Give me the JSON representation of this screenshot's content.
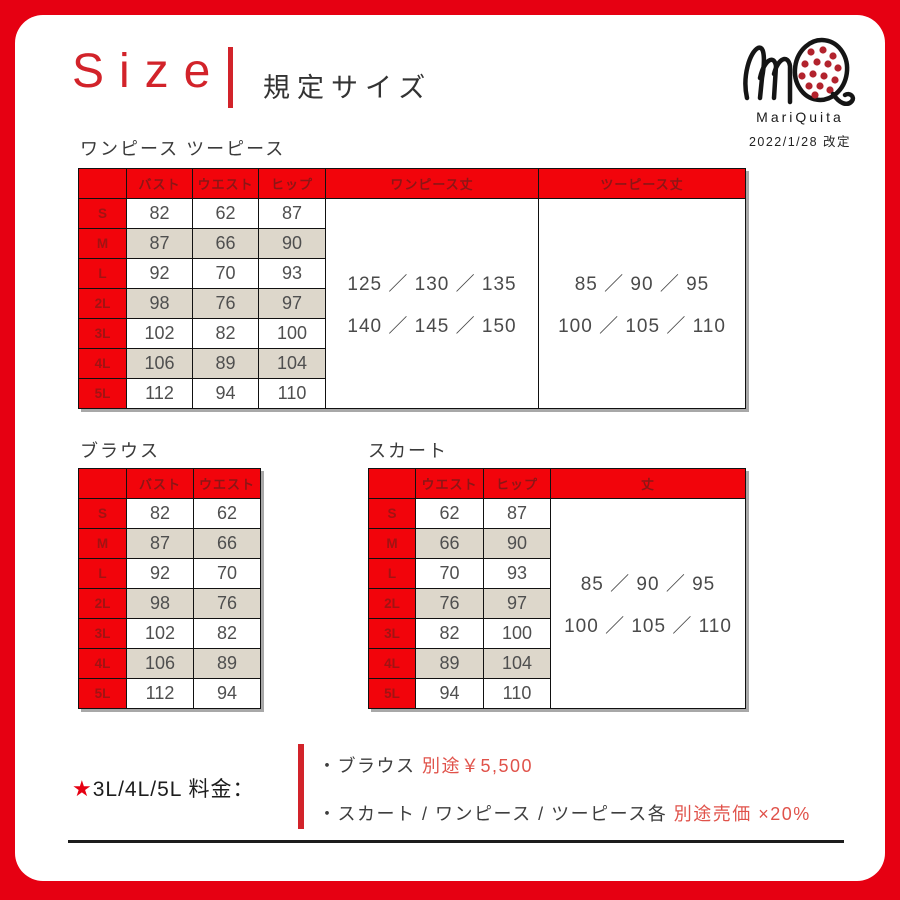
{
  "title": {
    "en": "Size",
    "ja": "規定サイズ"
  },
  "logo": {
    "name": "MariQuita",
    "revision": "2022/1/28 改定"
  },
  "colors": {
    "frame_red": "#e60012",
    "table_header_red": "#f2040b",
    "title_red": "#d2232a",
    "accent_text_red": "#e0524a",
    "alt_row_beige": "#ddd7cb",
    "logo_dot_red": "#b2232d"
  },
  "sections": {
    "onepiece": {
      "label": "ワンピース ツーピース",
      "measure_headers": [
        "バスト",
        "ウエスト",
        "ヒップ"
      ],
      "length_headers": [
        "ワンピース丈",
        "ツーピース丈"
      ],
      "sizes": [
        "S",
        "M",
        "L",
        "2L",
        "3L",
        "4L",
        "5L"
      ],
      "rows": [
        [
          82,
          62,
          87
        ],
        [
          87,
          66,
          90
        ],
        [
          92,
          70,
          93
        ],
        [
          98,
          76,
          97
        ],
        [
          102,
          82,
          100
        ],
        [
          106,
          89,
          104
        ],
        [
          112,
          94,
          110
        ]
      ],
      "onepiece_lengths": [
        "125 ／ 130 ／ 135",
        "140 ／ 145 ／ 150"
      ],
      "twopiece_lengths": [
        "85 ／ 90 ／ 95",
        "100 ／ 105 ／ 110"
      ]
    },
    "blouse": {
      "label": "ブラウス",
      "headers": [
        "バスト",
        "ウエスト"
      ],
      "sizes": [
        "S",
        "M",
        "L",
        "2L",
        "3L",
        "4L",
        "5L"
      ],
      "rows": [
        [
          82,
          62
        ],
        [
          87,
          66
        ],
        [
          92,
          70
        ],
        [
          98,
          76
        ],
        [
          102,
          82
        ],
        [
          106,
          89
        ],
        [
          112,
          94
        ]
      ]
    },
    "skirt": {
      "label": "スカート",
      "headers": [
        "ウエスト",
        "ヒップ",
        "丈"
      ],
      "sizes": [
        "S",
        "M",
        "L",
        "2L",
        "3L",
        "4L",
        "5L"
      ],
      "rows": [
        [
          62,
          87
        ],
        [
          66,
          90
        ],
        [
          70,
          93
        ],
        [
          76,
          97
        ],
        [
          82,
          100
        ],
        [
          89,
          104
        ],
        [
          94,
          110
        ]
      ],
      "lengths": [
        "85 ／ 90 ／ 95",
        "100 ／ 105 ／ 110"
      ]
    }
  },
  "pricing": {
    "star": "★",
    "label": "3L/4L/5L 料金：",
    "items": [
      {
        "prefix": "・ブラウス ",
        "highlight": "別途￥5,500"
      },
      {
        "prefix": "・スカート / ワンピース / ツーピース各 ",
        "highlight": "別途売価 ×20%"
      }
    ]
  }
}
